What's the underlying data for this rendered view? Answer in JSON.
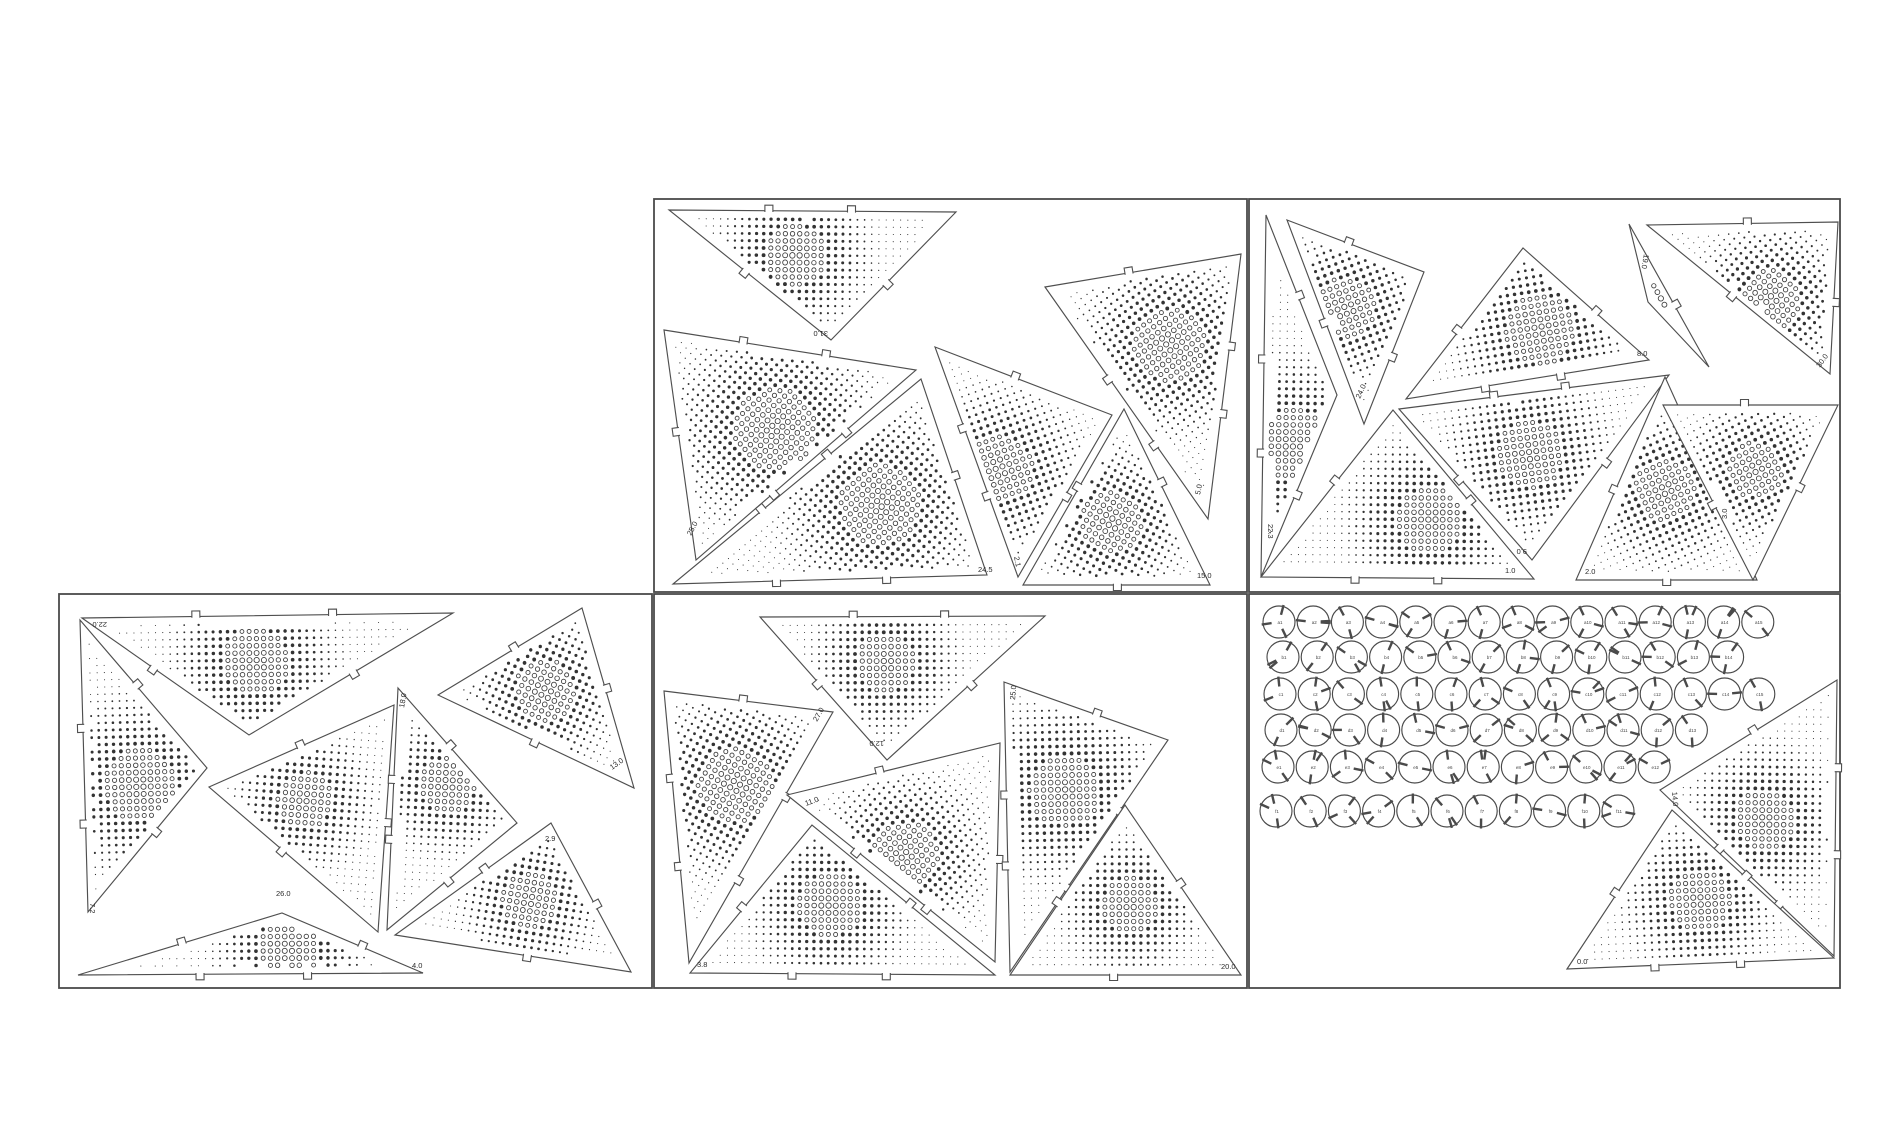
{
  "document": {
    "type_label": "laser-cut panel layout",
    "background": "#ffffff",
    "line_color": "#4a4a4a",
    "dot_color": "#333333",
    "canvas": {
      "width": 1900,
      "height": 1140
    }
  },
  "sheets": [
    {
      "name": "sheet-top-middle",
      "x": 654,
      "y": 199,
      "w": 593,
      "h": 393
    },
    {
      "name": "sheet-top-right",
      "x": 1249,
      "y": 199,
      "w": 591,
      "h": 393
    },
    {
      "name": "sheet-bottom-left",
      "x": 59,
      "y": 594,
      "w": 593,
      "h": 394
    },
    {
      "name": "sheet-bottom-middle",
      "x": 654,
      "y": 594,
      "w": 593,
      "h": 394
    },
    {
      "name": "sheet-bottom-right",
      "x": 1249,
      "y": 594,
      "w": 591,
      "h": 394
    }
  ],
  "triangles": [
    {
      "sheet": 0,
      "pts": [
        [
          669,
          210
        ],
        [
          956,
          212
        ],
        [
          831,
          340
        ]
      ],
      "label": "31.0",
      "lp": [
        828,
        331
      ],
      "rot": 180,
      "focus": [
        795,
        255
      ],
      "fall": 110
    },
    {
      "sheet": 0,
      "pts": [
        [
          664,
          330
        ],
        [
          916,
          370
        ],
        [
          696,
          560
        ]
      ],
      "label": "25.0",
      "lp": [
        691,
        536
      ],
      "rot": -62,
      "focus": [
        775,
        430
      ],
      "fall": 150
    },
    {
      "sheet": 0,
      "pts": [
        [
          921,
          379
        ],
        [
          987,
          575
        ],
        [
          673,
          584
        ]
      ],
      "label": "24.5",
      "lp": [
        978,
        572
      ],
      "rot": 0,
      "focus": [
        880,
        505
      ],
      "fall": 145
    },
    {
      "sheet": 0,
      "pts": [
        [
          935,
          347
        ],
        [
          1112,
          415
        ],
        [
          1018,
          577
        ]
      ],
      "label": "2.1",
      "lp": [
        1014,
        557
      ],
      "rot": 78,
      "focus": [
        1000,
        470
      ],
      "fall": 120
    },
    {
      "sheet": 0,
      "pts": [
        [
          1124,
          409
        ],
        [
          1210,
          585
        ],
        [
          1023,
          585
        ]
      ],
      "label": "15.0",
      "lp": [
        1197,
        578
      ],
      "rot": 0,
      "focus": [
        1112,
        522
      ],
      "fall": 110
    },
    {
      "sheet": 0,
      "pts": [
        [
          1045,
          287
        ],
        [
          1241,
          254
        ],
        [
          1208,
          519
        ]
      ],
      "label": "5.0",
      "lp": [
        1200,
        495
      ],
      "rot": -78,
      "focus": [
        1170,
        345
      ],
      "fall": 130
    },
    {
      "sheet": 1,
      "pts": [
        [
          1266,
          215
        ],
        [
          1337,
          395
        ],
        [
          1261,
          577
        ]
      ],
      "label": "22.3",
      "lp": [
        1268,
        524
      ],
      "rot": 90,
      "focus": [
        1292,
        445
      ],
      "fall": 130
    },
    {
      "sheet": 1,
      "pts": [
        [
          1287,
          220
        ],
        [
          1424,
          272
        ],
        [
          1364,
          424
        ]
      ],
      "label": "24.0",
      "lp": [
        1360,
        399
      ],
      "rot": -65,
      "focus": [
        1345,
        308
      ],
      "fall": 110
    },
    {
      "sheet": 1,
      "pts": [
        [
          1523,
          248
        ],
        [
          1406,
          399
        ],
        [
          1649,
          360
        ]
      ],
      "label": "8.0",
      "lp": [
        1637,
        356
      ],
      "rot": 0,
      "focus": [
        1540,
        330
      ],
      "fall": 125
    },
    {
      "sheet": 1,
      "pts": [
        [
          1393,
          410
        ],
        [
          1261,
          577
        ],
        [
          1534,
          579
        ]
      ],
      "label": "1.0",
      "lp": [
        1505,
        573
      ],
      "rot": 0,
      "focus": [
        1430,
        520
      ],
      "fall": 120
    },
    {
      "sheet": 1,
      "pts": [
        [
          1399,
          409
        ],
        [
          1669,
          375
        ],
        [
          1532,
          560
        ]
      ],
      "label": "9.0",
      "lp": [
        1527,
        549
      ],
      "rot": 180,
      "focus": [
        1530,
        455
      ],
      "fall": 120
    },
    {
      "sheet": 1,
      "pts": [
        [
          1665,
          377
        ],
        [
          1576,
          580
        ],
        [
          1757,
          580
        ]
      ],
      "label": "2.0",
      "lp": [
        1585,
        574
      ],
      "rot": 0,
      "focus": [
        1665,
        490
      ],
      "fall": 110
    },
    {
      "sheet": 1,
      "pts": [
        [
          1663,
          405
        ],
        [
          1838,
          405
        ],
        [
          1753,
          580
        ]
      ],
      "label": "3.0",
      "lp": [
        1727,
        519
      ],
      "rot": -90,
      "focus": [
        1755,
        470
      ],
      "fall": 100
    },
    {
      "sheet": 1,
      "pts": [
        [
          1647,
          225
        ],
        [
          1838,
          222
        ],
        [
          1830,
          374
        ]
      ],
      "label": "30.0",
      "lp": [
        1820,
        368
      ],
      "rot": -55,
      "focus": [
        1770,
        300
      ],
      "fall": 110
    },
    {
      "sheet": 1,
      "pts": [
        [
          1629,
          224
        ],
        [
          1709,
          367
        ],
        [
          1648,
          302
        ]
      ],
      "label": "19.0",
      "lp": [
        1644,
        254
      ],
      "rot": 100,
      "focus": [
        1660,
        300
      ],
      "fall": 80
    },
    {
      "sheet": 2,
      "pts": [
        [
          82,
          618
        ],
        [
          453,
          613
        ],
        [
          249,
          735
        ]
      ],
      "label": "22.0",
      "lp": [
        107,
        622
      ],
      "rot": 180,
      "focus": [
        255,
        662
      ],
      "fall": 120
    },
    {
      "sheet": 2,
      "pts": [
        [
          80,
          620
        ],
        [
          207,
          768
        ],
        [
          88,
          912
        ]
      ],
      "label": "7.2",
      "lp": [
        90,
        903
      ],
      "rot": 90,
      "focus": [
        140,
        785
      ],
      "fall": 130
    },
    {
      "sheet": 2,
      "pts": [
        [
          209,
          787
        ],
        [
          394,
          705
        ],
        [
          378,
          932
        ]
      ],
      "label": "26.0",
      "lp": [
        276,
        896
      ],
      "rot": 0,
      "focus": [
        305,
        800
      ],
      "fall": 100
    },
    {
      "sheet": 2,
      "pts": [
        [
          398,
          688
        ],
        [
          517,
          823
        ],
        [
          387,
          930
        ]
      ],
      "label": "18.0",
      "lp": [
        404,
        708
      ],
      "rot": -80,
      "focus": [
        448,
        785
      ],
      "fall": 100
    },
    {
      "sheet": 2,
      "pts": [
        [
          438,
          695
        ],
        [
          582,
          608
        ],
        [
          634,
          788
        ]
      ],
      "label": "13.0",
      "lp": [
        612,
        770
      ],
      "rot": -35,
      "focus": [
        545,
        690
      ],
      "fall": 110
    },
    {
      "sheet": 2,
      "pts": [
        [
          551,
          823
        ],
        [
          631,
          972
        ],
        [
          395,
          935
        ]
      ],
      "label": "2.9",
      "lp": [
        545,
        841
      ],
      "rot": 0,
      "focus": [
        530,
        900
      ],
      "fall": 100
    },
    {
      "sheet": 2,
      "pts": [
        [
          78,
          975
        ],
        [
          282,
          913
        ],
        [
          423,
          973
        ]
      ],
      "label": "4.0",
      "lp": [
        412,
        968
      ],
      "rot": 0,
      "focus": [
        290,
        948
      ],
      "fall": 110
    },
    {
      "sheet": 3,
      "pts": [
        [
          760,
          617
        ],
        [
          1045,
          616
        ],
        [
          887,
          760
        ]
      ],
      "label": "12.0",
      "lp": [
        884,
        741
      ],
      "rot": 180,
      "focus": [
        885,
        662
      ],
      "fall": 105
    },
    {
      "sheet": 3,
      "pts": [
        [
          664,
          691
        ],
        [
          833,
          712
        ],
        [
          689,
          963
        ]
      ],
      "label": "27.0",
      "lp": [
        817,
        722
      ],
      "rot": -60,
      "focus": [
        735,
        785
      ],
      "fall": 135
    },
    {
      "sheet": 3,
      "pts": [
        [
          812,
          825
        ],
        [
          690,
          973
        ],
        [
          995,
          975
        ]
      ],
      "label": "3.8",
      "lp": [
        697,
        967
      ],
      "rot": 0,
      "focus": [
        830,
        905
      ],
      "fall": 115
    },
    {
      "sheet": 3,
      "pts": [
        [
          787,
          795
        ],
        [
          1000,
          743
        ],
        [
          995,
          962
        ]
      ],
      "label": "11.0",
      "lp": [
        806,
        806
      ],
      "rot": -20,
      "focus": [
        905,
        855
      ],
      "fall": 120
    },
    {
      "sheet": 3,
      "pts": [
        [
          1004,
          682
        ],
        [
          1168,
          740
        ],
        [
          1010,
          972
        ]
      ],
      "label": "25.0",
      "lp": [
        1015,
        700
      ],
      "rot": -85,
      "focus": [
        1065,
        790
      ],
      "fall": 130
    },
    {
      "sheet": 3,
      "pts": [
        [
          1125,
          805
        ],
        [
          1010,
          975
        ],
        [
          1241,
          975
        ]
      ],
      "label": "20.0",
      "lp": [
        1221,
        969
      ],
      "rot": 0,
      "focus": [
        1130,
        905
      ],
      "fall": 100
    },
    {
      "sheet": 4,
      "pts": [
        [
          1660,
          790
        ],
        [
          1837,
          680
        ],
        [
          1834,
          956
        ]
      ],
      "label": "14.0",
      "lp": [
        1672,
        792
      ],
      "rot": 85,
      "focus": [
        1765,
        820
      ],
      "fall": 110
    },
    {
      "sheet": 4,
      "pts": [
        [
          1567,
          969
        ],
        [
          1672,
          810
        ],
        [
          1834,
          958
        ]
      ],
      "label": "0.0",
      "lp": [
        1577,
        964
      ],
      "rot": 0,
      "focus": [
        1700,
        900
      ],
      "fall": 110
    }
  ],
  "connectors": {
    "radius": 16,
    "col_spacing": 34.2,
    "rows": [
      {
        "y": 622,
        "x0": 1279,
        "count": 15
      },
      {
        "y": 657,
        "x0": 1283,
        "count": 14
      },
      {
        "y": 694,
        "x0": 1280,
        "count": 15
      },
      {
        "y": 730,
        "x0": 1281,
        "count": 13
      },
      {
        "y": 767,
        "x0": 1278,
        "count": 12
      },
      {
        "y": 811,
        "x0": 1276,
        "count": 11
      }
    ],
    "labels": [
      "a1",
      "a2",
      "a3",
      "a4",
      "a5",
      "a6",
      "a7",
      "a8",
      "a9",
      "a10",
      "a11",
      "a12",
      "a13",
      "a14",
      "a15",
      "b1",
      "b2",
      "b3",
      "b4",
      "b5",
      "b6",
      "b7",
      "b8",
      "b9",
      "b10",
      "b11",
      "b12",
      "b13",
      "b14",
      "c1",
      "c2",
      "c3",
      "c4",
      "c5",
      "c6",
      "c7",
      "c8",
      "c9",
      "c10",
      "c11",
      "c12",
      "c13",
      "c14",
      "c15",
      "d1",
      "d2",
      "d3",
      "d4",
      "d5",
      "d6",
      "d7",
      "d8",
      "d9",
      "d10",
      "d11",
      "d12",
      "d13",
      "e1",
      "e2",
      "e3",
      "e4",
      "e5",
      "e6",
      "e7",
      "e8",
      "e9",
      "e10",
      "e11",
      "e12",
      "f1",
      "f2",
      "f3",
      "f4",
      "f5",
      "f6",
      "f7",
      "f8",
      "f9",
      "f10",
      "f11"
    ]
  },
  "halftone": {
    "spacing": 7.2,
    "max_dot_radius": 2.7,
    "edge_margin": 8.5
  }
}
